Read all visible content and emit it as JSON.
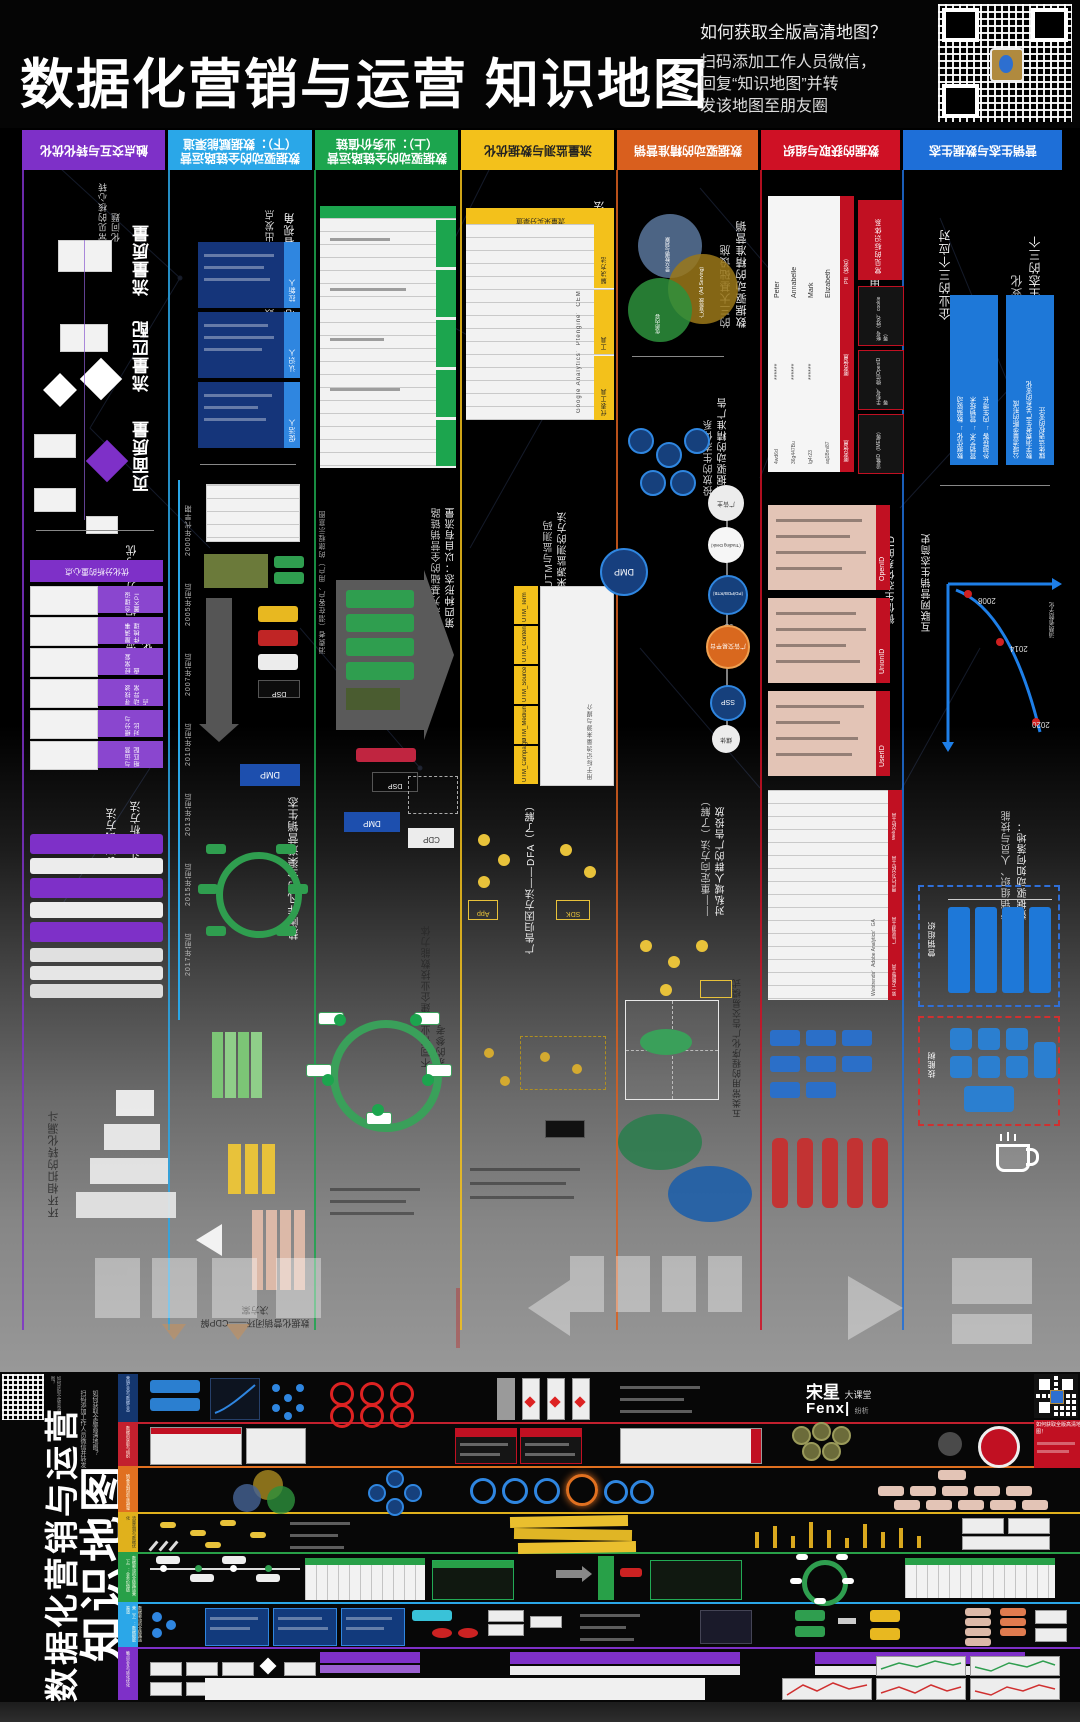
{
  "header": {
    "title": "数据化营销与运营 知识地图",
    "question": "如何获取全版高清地图？",
    "instruction_lines": [
      "扫码添加工作人员微信，",
      "回复“知识地图”并转",
      "发该地图至朋友圈"
    ]
  },
  "sections": [
    {
      "id": "s1",
      "title": "触点交互与转化优化",
      "color": "#7e30c8"
    },
    {
      "id": "s2",
      "title": "数据驱动的全链路运营（下）：数据赋能渠道",
      "color": "#2aa7e8"
    },
    {
      "id": "s3",
      "title": "数据驱动的全链路运营（上）：业务价值链",
      "color": "#1ca54e"
    },
    {
      "id": "s4",
      "title": "流量监测与数据优化",
      "color": "#f3c11b"
    },
    {
      "id": "s5",
      "title": "数据驱动的精准营销",
      "color": "#d95f1e"
    },
    {
      "id": "s6",
      "title": "数据的获取与组织",
      "color": "#cf1125"
    },
    {
      "id": "s7",
      "title": "营销生态与数据生态",
      "color": "#1e6fd8"
    }
  ],
  "col1": {
    "intro": "常见的核心转化问题",
    "labels": [
      "流量质量",
      "流量匹配",
      "页面质量"
    ],
    "steps_title": "流量数据的分析与优化步骤",
    "table_header": "优化分析的重心点",
    "rows": [
      "合理设置KPI",
      "厘清事件梳理",
      "经常复盘",
      "寻找波动异常点",
      "细分与对比",
      "与运营相匹配"
    ],
    "methods": [
      "AB测试方法",
      "漏斗分析方法"
    ],
    "funnel_title": "环环相扣的转化漏斗"
  },
  "col2": {
    "core_lines": [
      "核心工作：消费者视角",
      "全链路数据策略的三个出发点"
    ],
    "persona_rows": [
      "拉新人",
      "认识人",
      "促活人"
    ],
    "history_label": "简史",
    "timeline": [
      "2000年代早期",
      "2005年前后",
      "2007年前后",
      "2010年前后",
      "2013年前后",
      "2015年前后",
      "2017年前后"
    ],
    "eco_title": "热闹非凡的全渠道营销生态",
    "cdp_title": "数据化营销闭环——CDP解决方案",
    "dmp": "DMP",
    "dsp": "DSP"
  },
  "col3": {
    "forms_title": "渠道数据的四种形态",
    "journey_note": "消费者（潜在客户、用户）的旅程示意图",
    "fourth_lines": [
      "第四种形态：以自有流量",
      "生态为基础的全营销链路"
    ],
    "nodes": [
      "DSP",
      "DMP",
      "CDP"
    ],
    "cycle_title": "不同行业构建企业技数能力体系的参考"
  },
  "col4": {
    "collect_title": "流量数据采集的方法",
    "table1_header": "流量采买分渠道",
    "table1_rows": [
      "解决方法",
      "工具",
      "代表工具"
    ],
    "table1_tool": "Google Analytics、Ptengine、CEM",
    "utm_lines": [
      "流量来源监测的方法",
      "——UTM与监测码"
    ],
    "utm_rows": [
      "UTM_Campaign",
      "UTM_Medium",
      "UTM_Source",
      "UTM_Content",
      "UTM_Term"
    ],
    "utm_desc": "用于标记流量来源与媒介",
    "dfa_title": "广告归因方法——DFA（了解）",
    "app_label": "App",
    "sdk_label": "SDK"
  },
  "col5": {
    "infra_lines": [
      "数据驱动的精准营销",
      "的三大基础设施"
    ],
    "venn": [
      "受众数据与洞察",
      "广告投放（Ad Serving）",
      "优质内容"
    ],
    "eco_lines": [
      "数据驱动的精准广告",
      "投放的生态体系"
    ],
    "chain": [
      "广告主",
      "（Trading Desk）",
      "DSP（PD/PDB/RTB）",
      "广告交易平台",
      "SSP",
      "媒体"
    ],
    "dmp": "DMP",
    "retarget_lines": [
      "对私域人群的广告投放",
      "——重定向方法（了解）"
    ],
    "modes_note": "五类常用的程序化广告交易模式"
  },
  "col6": {
    "id_title": "消费者（用户）ID的分类",
    "pii_names": [
      "Peter",
      "Annabelle",
      "Mark",
      "Elizabeth"
    ],
    "masked": "******",
    "hashes": [
      "4wd6d",
      "36g447Bu",
      "lg4r23",
      "aq1Bmi87"
    ],
    "pii_cols": [
      "PII（姓名）",
      "匿名信息",
      "匿名信息"
    ],
    "id_types_title": "常见的标识体系",
    "id_types": [
      "帐号（姓名、cookie等）",
      "手机号、微信OpenID等",
      "设备ID（IMEI等）"
    ],
    "wechat_title": "微信生态体系的ID",
    "id_blocks": [
      "OpenID",
      "UnionID",
      "UserID"
    ],
    "tools_rows": [
      "Web分析工具",
      "用户行为分析工具",
      "广告监测工具",
      "第一方数据工具"
    ],
    "tools_examples": "Webtrends、Adobe Analytics、GA"
  },
  "col7": {
    "change_lines": [
      "营销生态的三个",
      "深刻变化"
    ],
    "react_title": "企业的三个应对",
    "box1_lines": [
      "媒体话语权的变迁",
      "数字消费者生产关系的变化",
      "公域流量垄断的形成"
    ],
    "box2_lines": [
      "外部获客 → 内生增长",
      "营销艺术 → 营销技术",
      "数据优化 → 数据驱动"
    ],
    "history_title": "互联网营销生态简史",
    "chart_years": [
      "2008",
      "2014",
      "2020"
    ],
    "chart_axis": "消费者数字化",
    "landing_lines": [
      "数据驱动如何落地：",
      "营销组织、人员与技能"
    ],
    "org_label": "营销组织",
    "skill_label": "技能树"
  },
  "strip": {
    "title_main": "数据化营销与运营",
    "title_sub": "知识地图",
    "note_lines": [
      "如何获取全版高清地图？",
      "扫码添加工作人员微信并转发"
    ],
    "brand_cn": "宋星",
    "brand_cn2": "大课堂",
    "brand_en": "Fenx|",
    "brand_sub": "纷析",
    "promo": "如何获取全版高清地图！"
  }
}
